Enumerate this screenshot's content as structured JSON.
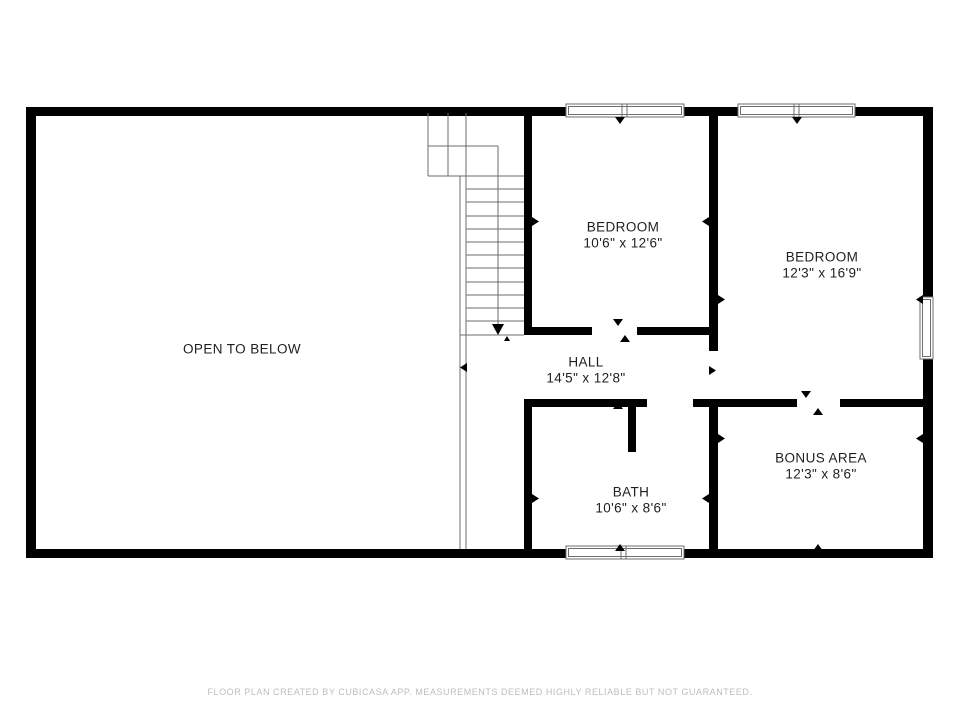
{
  "plan": {
    "title": "Second floor plan",
    "rooms": [
      {
        "id": "open-to-below",
        "label": "OPEN TO BELOW",
        "dims": ""
      },
      {
        "id": "bedroom-1",
        "label": "BEDROOM",
        "dims": "10'6\" x 12'6\""
      },
      {
        "id": "bedroom-2",
        "label": "BEDROOM",
        "dims": "12'3\" x 16'9\""
      },
      {
        "id": "hall",
        "label": "HALL",
        "dims": "14'5\" x 12'8\""
      },
      {
        "id": "bath",
        "label": "BATH",
        "dims": "10'6\" x 8'6\""
      },
      {
        "id": "bonus-area",
        "label": "BONUS AREA",
        "dims": "12'3\" x 8'6\""
      }
    ],
    "footer": "FLOOR PLAN CREATED BY CUBICASA APP. MEASUREMENTS DEEMED HIGHLY RELIABLE BUT NOT GUARANTEED.",
    "colors": {
      "wall": "#000000",
      "line": "#6e6e6e",
      "window_fill": "#ffffff",
      "label": "#1f1f1f",
      "footer": "#bdbdbd",
      "background": "#ffffff"
    }
  }
}
